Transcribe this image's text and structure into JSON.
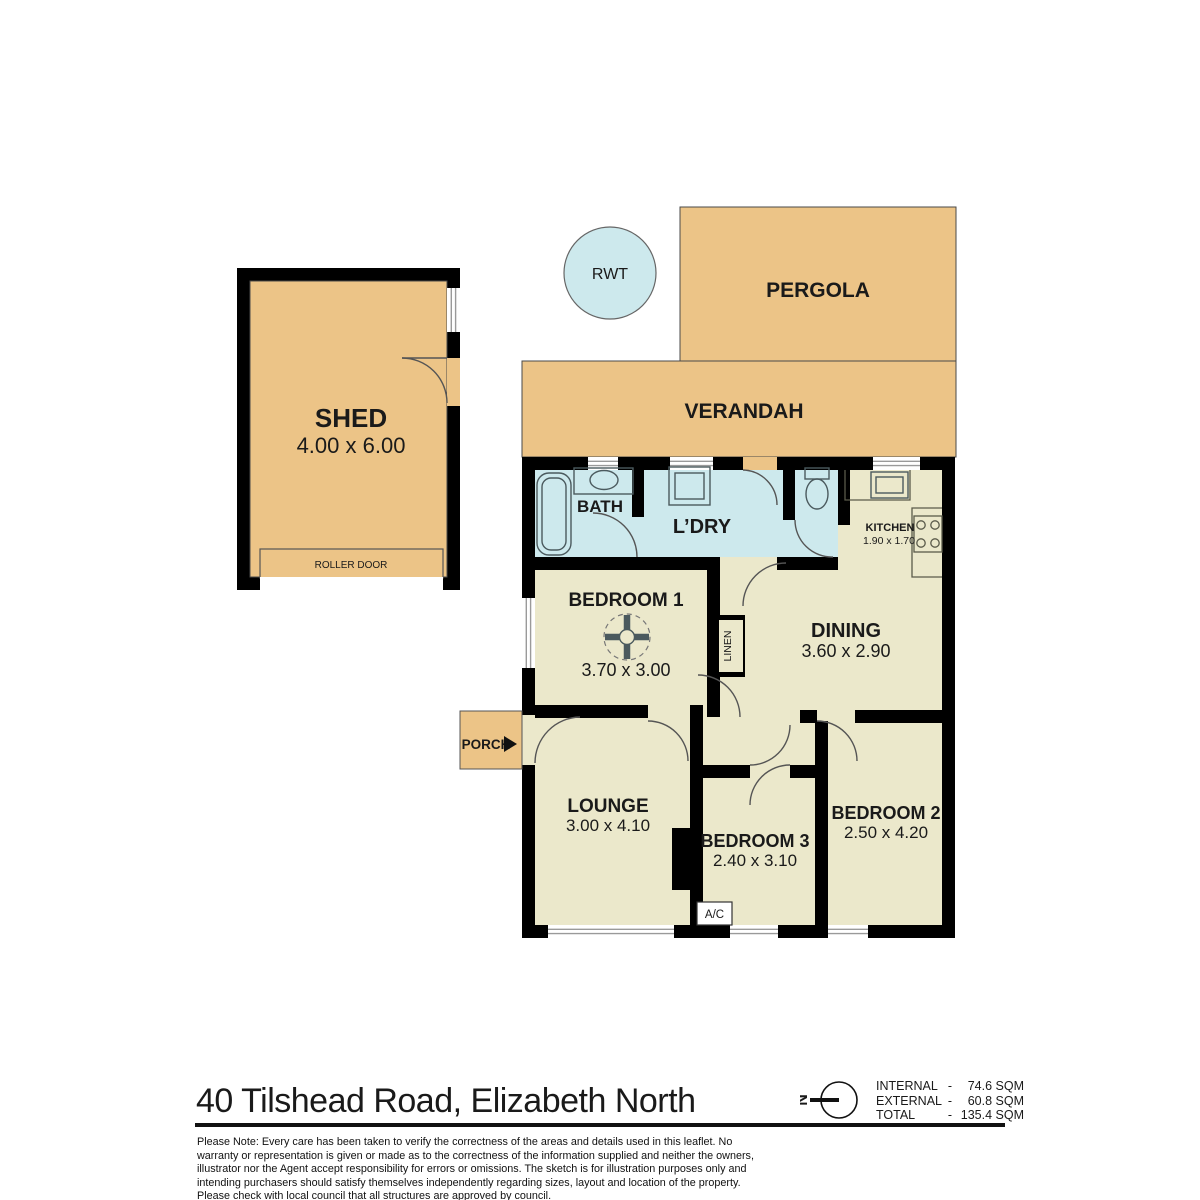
{
  "plan": {
    "outdoor": {
      "pergola": "PERGOLA",
      "verandah": "VERANDAH",
      "rwt": "RWT",
      "porch": "PORCH"
    },
    "shed": {
      "name": "SHED",
      "dims": "4.00 x 6.00",
      "roller_door": "ROLLER DOOR"
    },
    "rooms": {
      "bath": {
        "name": "BATH"
      },
      "laundry": {
        "name": "L’DRY"
      },
      "kitchen": {
        "name": "KITCHEN",
        "dims": "1.90 x 1.70"
      },
      "bedroom1": {
        "name": "BEDROOM 1",
        "dims": "3.70 x 3.00"
      },
      "linen": {
        "name": "LINEN"
      },
      "dining": {
        "name": "DINING",
        "dims": "3.60 x 2.90"
      },
      "lounge": {
        "name": "LOUNGE",
        "dims": "3.00 x 4.10"
      },
      "bedroom3": {
        "name": "BEDROOM 3",
        "dims": "2.40 x 3.10"
      },
      "bedroom2": {
        "name": "BEDROOM 2",
        "dims": "2.50 x 4.20"
      },
      "ac": "A/C"
    },
    "compass": {
      "label": "N"
    }
  },
  "footer": {
    "address": "40 Tilshead Road, Elizabeth North",
    "areas": [
      {
        "label": "INTERNAL",
        "sep": "-",
        "value": "74.6 SQM"
      },
      {
        "label": "EXTERNAL",
        "sep": "-",
        "value": "60.8 SQM"
      },
      {
        "label": "TOTAL",
        "sep": "-",
        "value": "135.4 SQM"
      }
    ],
    "disclaimer": "Please Note: Every care has been taken to verify the correctness of the areas and details used in this leaflet. No warranty or representation is given or made as to the correctness of the information supplied and neither the owners, illustrator nor the Agent accept responsibility for errors or omissions. The sketch is for illustration purposes only and intending purchasers should satisfy themselves independently regarding sizes, layout and location of the property. Please check with local council that all structures are approved by council."
  },
  "colors": {
    "outdoor": "#ecc487",
    "wet": "#cde9ed",
    "interior": "#ebe8cb",
    "wall": "#000000"
  }
}
